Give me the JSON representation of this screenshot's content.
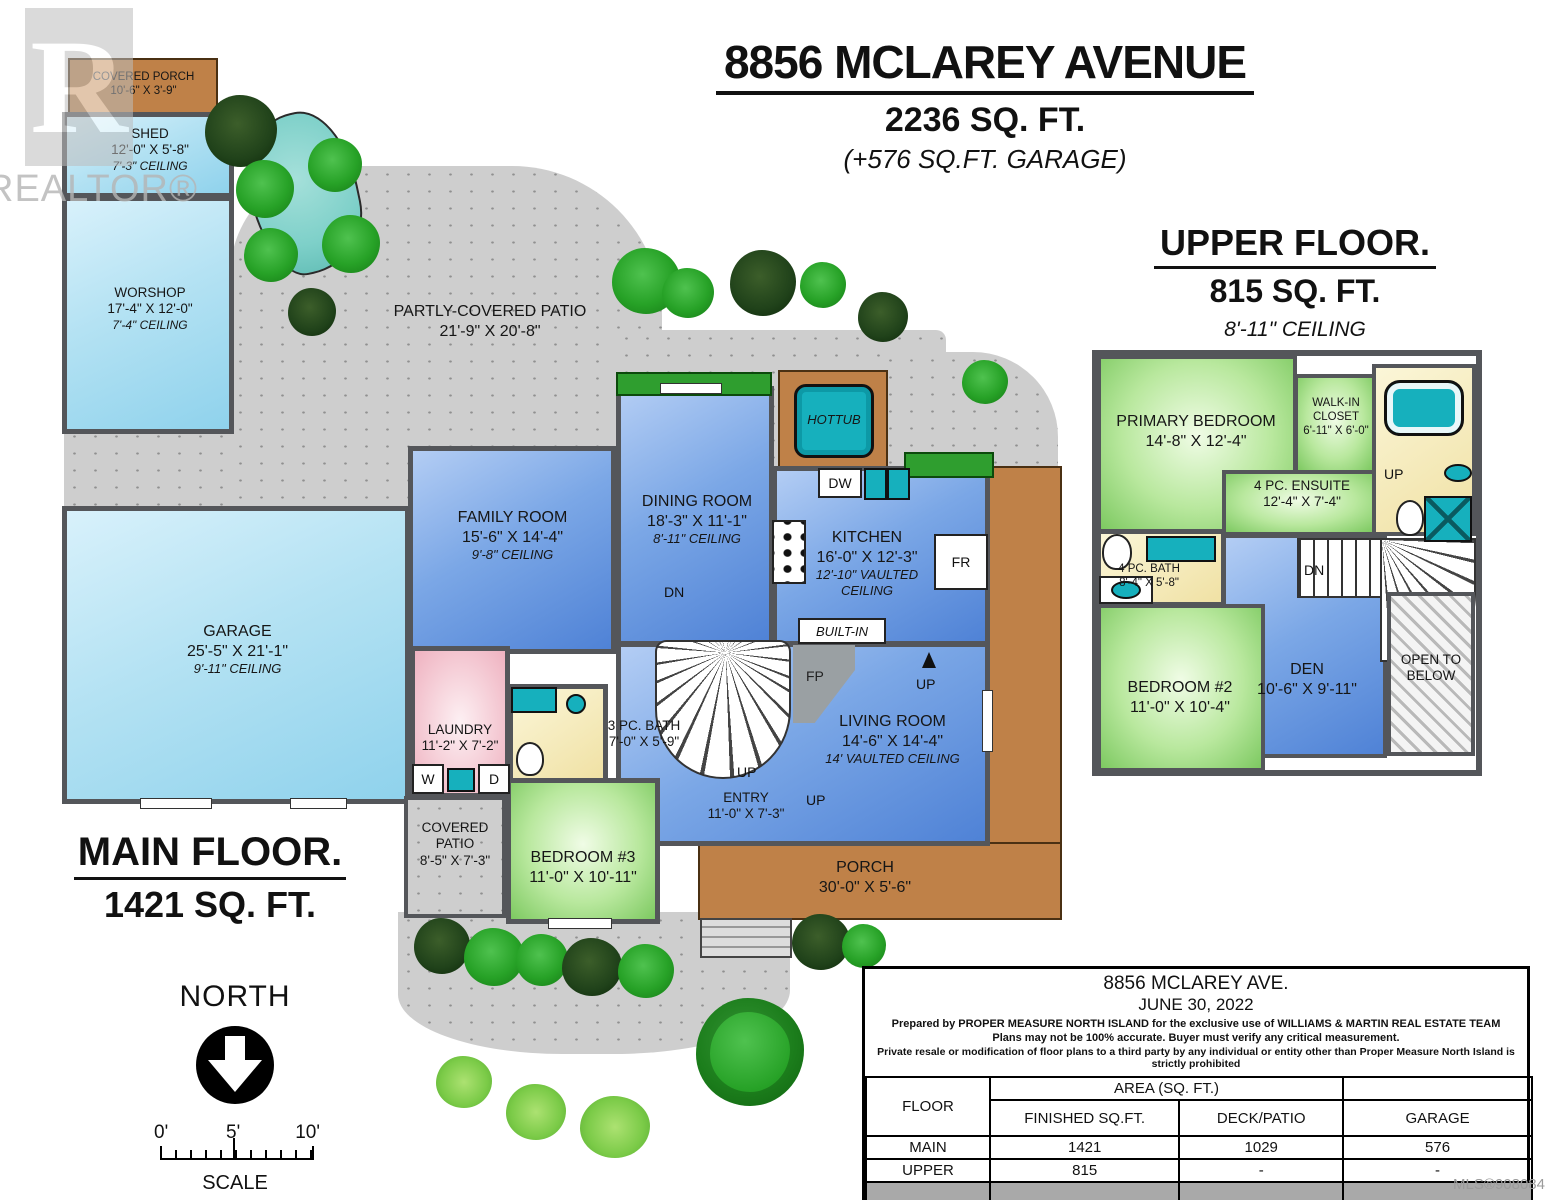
{
  "title": {
    "address": "8856 MCLAREY AVENUE",
    "area": "2236 SQ. FT.",
    "garage_note": "(+576 SQ.FT. GARAGE)"
  },
  "upper_title": {
    "name": "UPPER FLOOR.",
    "area": "815 SQ. FT.",
    "ceiling": "8'-11\" CEILING"
  },
  "main_title": {
    "name": "MAIN FLOOR.",
    "area": "1421 SQ. FT."
  },
  "watermark": {
    "logo_letter": "R",
    "text": "REALTOR®"
  },
  "north": {
    "label": "NORTH",
    "scale0": "0'",
    "scale5": "5'",
    "scale10": "10'",
    "scale_label": "SCALE"
  },
  "rooms": {
    "main": {
      "covered_porch": {
        "name": "COVERED PORCH",
        "dims": "10'-6\" X 3'-9\""
      },
      "shed": {
        "name": "SHED",
        "dims": "12'-0\" X 5'-8\"",
        "ceiling": "7'-3\" CEILING"
      },
      "workshop": {
        "name": "WORSHOP",
        "dims": "17'-4\" X 12'-0\"",
        "ceiling": "7'-4\" CEILING"
      },
      "patio": {
        "name": "PARTLY-COVERED PATIO",
        "dims": "21'-9\" X 20'-8\""
      },
      "hottub": {
        "name": "HOTTUB"
      },
      "family": {
        "name": "FAMILY ROOM",
        "dims": "15'-6\" X 14'-4\"",
        "ceiling": "9'-8\" CEILING"
      },
      "dining": {
        "name": "DINING ROOM",
        "dims": "18'-3\" X 11'-1\"",
        "ceiling": "8'-11\" CEILING"
      },
      "kitchen": {
        "name": "KITCHEN",
        "dims": "16'-0\" X 12'-3\"",
        "ceiling": "12'-10\" VAULTED CEILING"
      },
      "garage": {
        "name": "GARAGE",
        "dims": "25'-5\" X 21'-1\"",
        "ceiling": "9'-11\" CEILING"
      },
      "laundry": {
        "name": "LAUNDRY",
        "dims": "11'-2\" X 7'-2\""
      },
      "bath3": {
        "name": "3 PC. BATH",
        "dims": "7'-0\" X 5'-9\""
      },
      "entry": {
        "name": "ENTRY",
        "dims": "11'-0\" X 7'-3\""
      },
      "living": {
        "name": "LIVING ROOM",
        "dims": "14'-6\" X 14'-4\"",
        "ceiling": "14' VAULTED CEILING"
      },
      "bedroom3": {
        "name": "BEDROOM #3",
        "dims": "11'-0\" X 10'-11\""
      },
      "covered_patio": {
        "name": "COVERED PATIO",
        "dims": "8'-5\" X 7'-3\""
      },
      "porch": {
        "name": "PORCH",
        "dims": "30'-0\" X 5'-6\""
      }
    },
    "upper": {
      "primary": {
        "name": "PRIMARY BEDROOM",
        "dims": "14'-8\" X 12'-4\""
      },
      "walkin": {
        "name": "WALK-IN CLOSET",
        "dims": "6'-11\" X 6'-0\""
      },
      "ensuite": {
        "name": "4 PC. ENSUITE",
        "dims": "12'-4\" X 7'-4\""
      },
      "bath4": {
        "name": "4 PC. BATH",
        "dims": "8'-4\" X 5'-8\""
      },
      "bedroom2": {
        "name": "BEDROOM #2",
        "dims": "11'-0\" X 10'-4\""
      },
      "den": {
        "name": "DEN",
        "dims": "10'-6\" X 9'-11\""
      },
      "open_below": {
        "name": "OPEN TO BELOW"
      }
    }
  },
  "markers": {
    "dw": "DW",
    "fr": "FR",
    "w": "W",
    "d": "D",
    "up": "UP",
    "dn": "DN",
    "fp": "FP",
    "built_in": "BUILT-IN"
  },
  "info_table": {
    "title1": "8856 MCLAREY AVE.",
    "title2": "JUNE 30, 2022",
    "note1": "Prepared by PROPER MEASURE NORTH ISLAND for the exclusive use of WILLIAMS & MARTIN REAL ESTATE TEAM",
    "note2": "Plans may not be 100% accurate.  Buyer must verify any critical measurement.",
    "note3": "Private resale  or modification of floor plans to a third party by any individual or entity other than Proper Measure North Island is strictly prohibited",
    "header_floor": "FLOOR",
    "header_area": "AREA (SQ. FT.)",
    "col_finished": "FINISHED SQ.FT.",
    "col_deck": "DECK/PATIO",
    "col_garage": "GARAGE",
    "rows": [
      {
        "floor": "MAIN",
        "finished": "1421",
        "deck": "1029",
        "garage": "576"
      },
      {
        "floor": "UPPER",
        "finished": "815",
        "deck": "-",
        "garage": "-"
      },
      {
        "floor": "TOTAL",
        "finished": "2236",
        "deck": "1029",
        "garage": "576"
      }
    ]
  },
  "mls": "MLS®908084"
}
